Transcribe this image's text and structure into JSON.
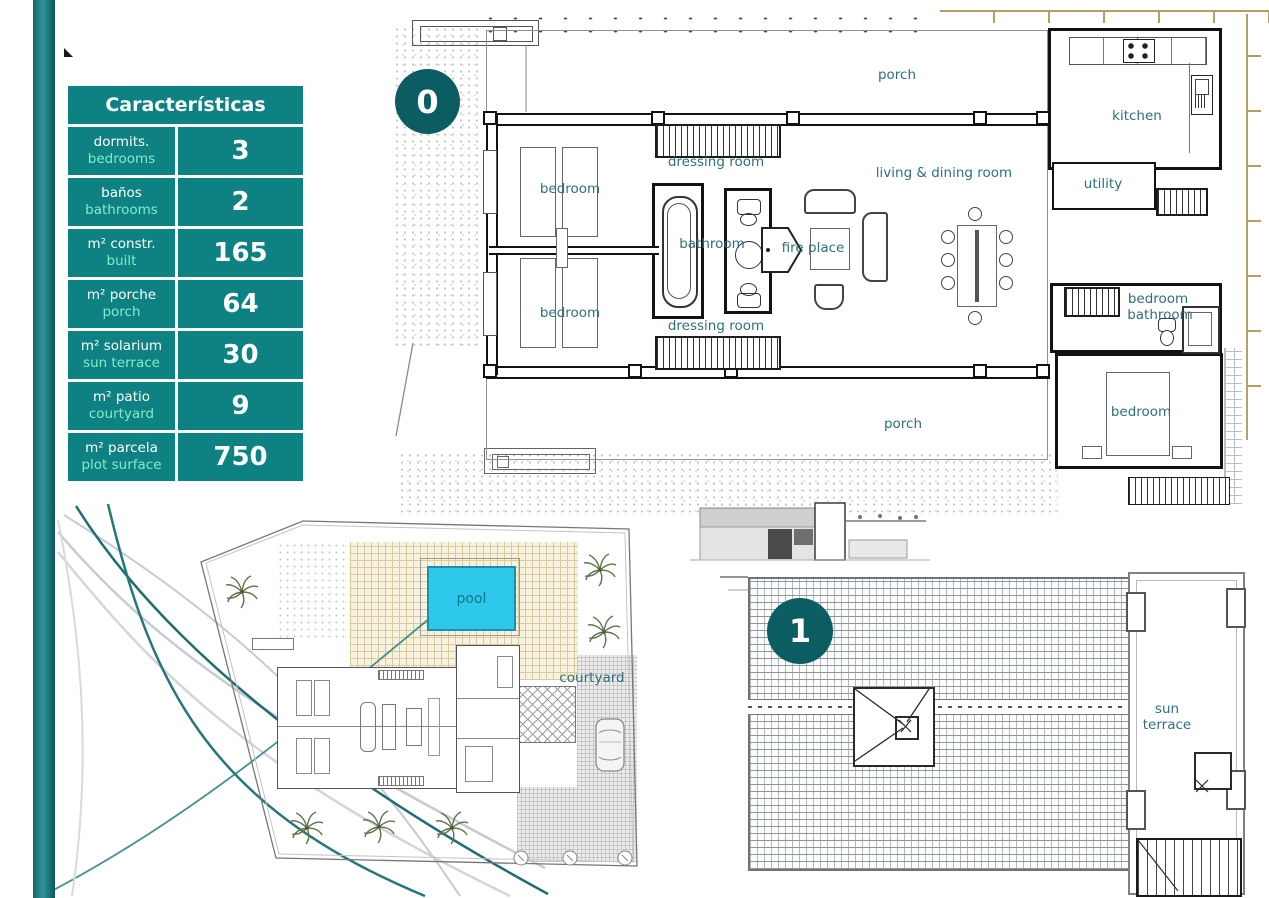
{
  "characteristics": {
    "title": "Características",
    "rows": [
      {
        "es": "dormits.",
        "en": "bedrooms",
        "value": "3"
      },
      {
        "es": "baños",
        "en": "bathrooms",
        "value": "2"
      },
      {
        "es": "m² constr.",
        "en": "built",
        "value": "165"
      },
      {
        "es": "m² porche",
        "en": "porch",
        "value": "64"
      },
      {
        "es": "m² solarium",
        "en": "sun terrace",
        "value": "30"
      },
      {
        "es": "m² patio",
        "en": "courtyard",
        "value": "9"
      },
      {
        "es": "m² parcela",
        "en": "plot surface",
        "value": "750"
      }
    ]
  },
  "floor0": {
    "badge": "0",
    "porch_top": "porch",
    "porch_bottom": "porch",
    "dressing_top": "dressing room",
    "dressing_bottom": "dressing room",
    "bedroom_top": "bedroom",
    "bedroom_bottom": "bedroom",
    "bathroom": "bathroom",
    "fireplace": "fire place",
    "living": "living & dining room",
    "kitchen": "kitchen",
    "utility": "utility",
    "suite_bedroom": "bedroom",
    "suite_bathroom": "bathroom",
    "bedroom3": "bedroom"
  },
  "site": {
    "pool": "pool",
    "courtyard": "courtyard"
  },
  "floor1": {
    "badge": "1",
    "sun_terrace": "sun terrace"
  },
  "colors": {
    "table_teal": "#0e8283",
    "badge_teal": "#0c5d62",
    "mint_text": "#82ebc8",
    "label_teal": "#2f6f7c",
    "pool_cyan": "#2ec8ea",
    "fence_tan": "#b3a065"
  }
}
